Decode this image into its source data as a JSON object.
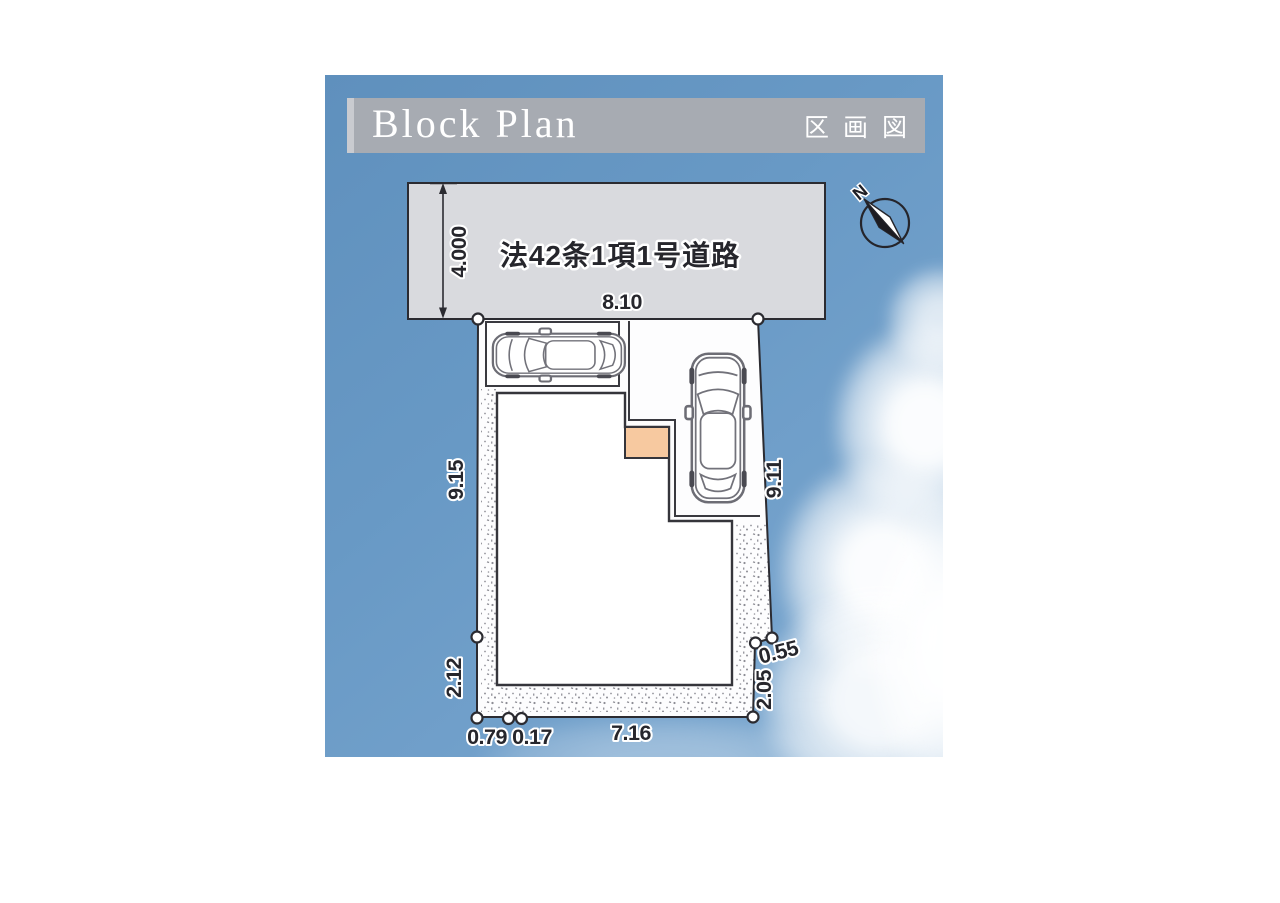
{
  "header": {
    "title": "Block Plan",
    "subtitle": "区画図"
  },
  "plan": {
    "road_label": "法42条1項1号道路",
    "compass": {
      "north_label": "N"
    },
    "dimensions": {
      "road_width": "4.000",
      "frontage": "8.10",
      "left_upper": "9.15",
      "left_lower": "2.12",
      "right_upper": "9.11",
      "right_jog": "0.55",
      "right_lower": "2.05",
      "bottom_left": "0.79",
      "bottom_mid": "0.17",
      "bottom_main": "7.16"
    }
  },
  "colors": {
    "sky": "#6899c5",
    "header_bar": "#a7abb2",
    "header_accent": "#c9cbd0",
    "header_text": "#ffffff",
    "road_fill": "#d9dade",
    "outline": "#2b2b31",
    "building_fill": "#ffffff",
    "porch_fill": "#f7c9a0",
    "page_background": "#ffffff"
  }
}
